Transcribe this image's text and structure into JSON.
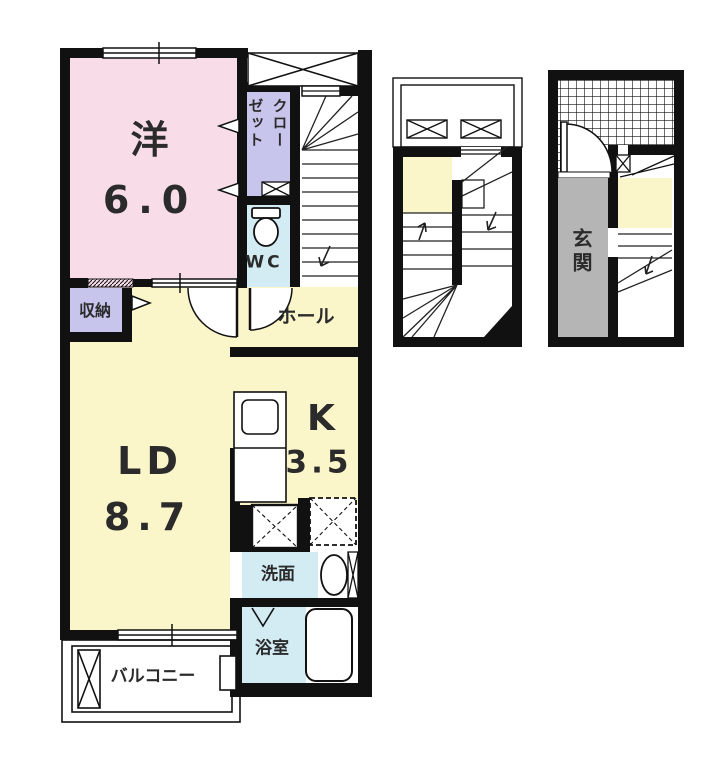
{
  "plan": {
    "unit_rooms": {
      "western": {
        "name": "洋",
        "size": "6.0"
      },
      "closet": {
        "label": "クローゼット",
        "cols": [
          "クロー",
          "ゼット"
        ]
      },
      "wc": {
        "label": "WC"
      },
      "hall": {
        "label": "ホール"
      },
      "storage": {
        "label": "収納"
      },
      "living_dining": {
        "name": "LD",
        "size": "8.7"
      },
      "kitchen": {
        "name": "K",
        "size": "3.5"
      },
      "washroom": {
        "label": "洗面"
      },
      "bathroom": {
        "label": "浴室"
      },
      "balcony": {
        "label": "バルコニー"
      },
      "entrance": {
        "label": "玄関"
      }
    },
    "colors": {
      "room_pink": "#f8dde8",
      "closet_lavender": "#c7c5ec",
      "wet_area_cyan": "#d3ecf4",
      "living_yellow": "#faf6ca",
      "entrance_gray": "#b5b5b5",
      "wall_black": "#111111"
    }
  }
}
